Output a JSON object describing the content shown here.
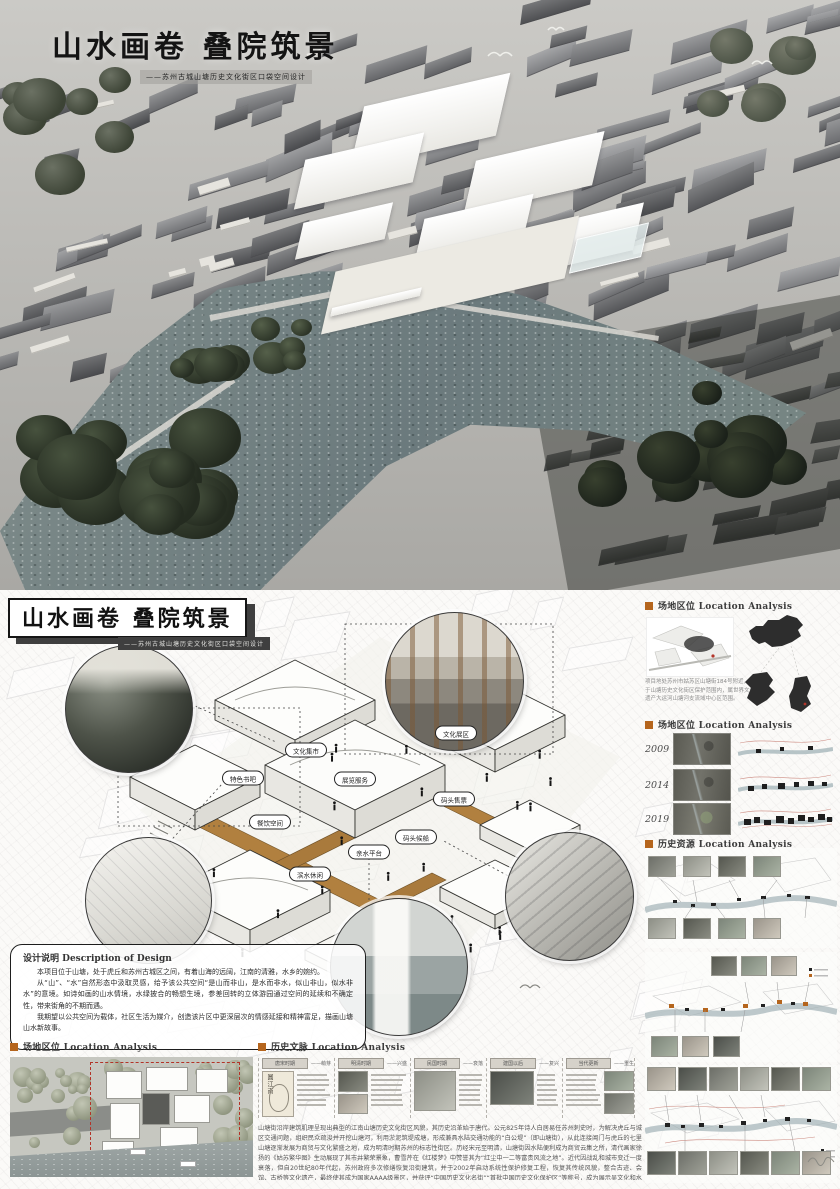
{
  "title": {
    "main": "山水画卷 叠院筑景",
    "subtitle": "——苏州古城山塘历史文化街区口袋空间设计"
  },
  "colors": {
    "accent": "#b5651d",
    "walkway": "#b0803f",
    "water": "#75847f",
    "ink": "#1c1c1c"
  },
  "icons": {
    "section_marker": "orange-square",
    "seagull": "curved-stroke"
  },
  "diagram": {
    "labels": [
      "文化集市",
      "文化展区",
      "特色书吧",
      "展览服务",
      "餐饮空间",
      "码头售票",
      "码头候船",
      "亲水平台",
      "滨水休闲"
    ]
  },
  "design_note": {
    "heading": "设计说明 Description of Design",
    "p1": "本项目位于山塘，处于虎丘和苏州古城区之间，有着山海的远阔，江南的清雅，水乡的婉约。",
    "p2": "从“山”、“水”自然形态中汲取灵感，给予该公共空间“是山而非山，是水而非水，似山非山，似水非水”的意境。如诗如画的山水情境，水绿披合的畅想生境，参差回转的立体游园通过空间的延续和不确定性，带来街角的不期而遇。",
    "p3": "我期望以公共空间为载体，社区生活为媒介，创造该片区中更深层次的情感延接和精神富足，描画山塘山水新故事。"
  },
  "sidebar": {
    "section1": {
      "title": "场地区位 Location Analysis",
      "note": "项目地处苏州市姑苏区山塘街184号附近，位于山塘历史文化街区保护范围内，属世界文化遗产大运河山塘河支流域中心区范围。"
    },
    "section2": {
      "title": "场地区位 Location Analysis",
      "years": [
        "2009",
        "2014",
        "2019"
      ]
    },
    "section3": {
      "title": "历史资源 Location Analysis"
    }
  },
  "bottom": {
    "site_section_title": "场地区位 Location Analysis",
    "history": {
      "title": "历史文脉 Location Analysis",
      "map_seal": "圆江南",
      "cards": [
        {
          "era": "唐宋时期",
          "tag": "——萌芽"
        },
        {
          "era": "明清时期",
          "tag": "——兴盛"
        },
        {
          "era": "民国时期",
          "tag": "——衰落"
        },
        {
          "era": "建国以后",
          "tag": "——复兴"
        },
        {
          "era": "当代更新",
          "tag": "——重生"
        }
      ],
      "paragraph": "山塘街沿岸建筑肌理呈现出典型的江南山塘历史文化街区风貌，其历史沿革始于唐代。公元825年诗人白居易任苏州刺史时，为解决虎丘与城区交通问题，组织民众疏浚并开挖山塘河，利用淤泥筑堤成塘，形成兼具水陆交通功能的“白公堤”（即山塘街），从此连接阊门与虎丘的七里山塘逐渐发展为商贸与文化繁盛之地，成为明清时期苏州的标志性街区。历经宋元至明清，山塘街因水陆便利成为商贸云集之所，清代画家徐扬的《姑苏繁华图》生动展现了其市井繁荣景象，曹雪芹在《红楼梦》中赞誉其为“红尘中一二等富贵风流之地”。近代因战乱和城市变迁一度衰落，但自20世纪80年代起，苏州政府多次修缮恢复沿街建筑，并于2002年启动系统性保护修复工程，恢复其传统风貌，整合古迹、会馆、古桥等文化遗产，最终使其成为国家AAAA级景区，并获评“中国历史文化名街”“首批中国历史文化保护区”等称号，成为展示吴文化和水乡风貌的窗口。"
    }
  }
}
